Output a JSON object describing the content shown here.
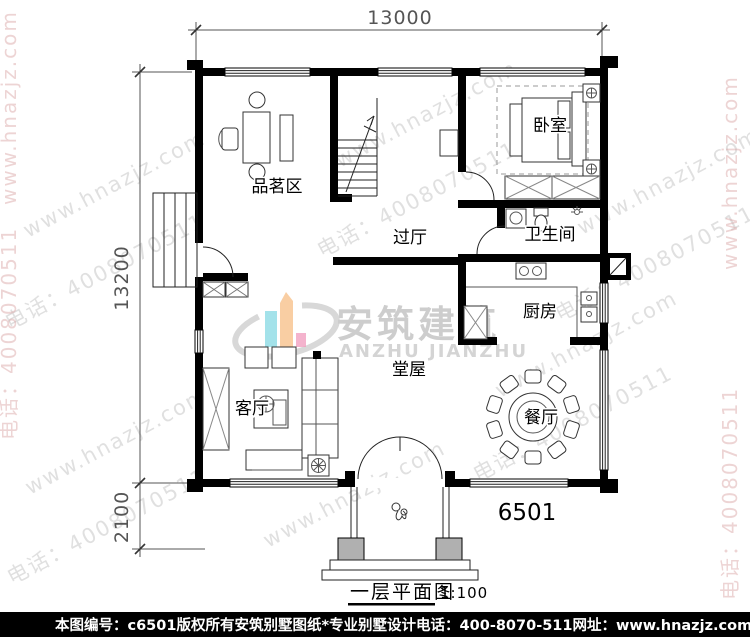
{
  "dimensions": {
    "width_top": "13000",
    "height_main": "13200",
    "height_porch": "2100"
  },
  "rooms": {
    "tea": "品茗区",
    "bedroom": "卧室",
    "hallway": "过厅",
    "bathroom": "卫生间",
    "kitchen": "厨房",
    "hall": "堂屋",
    "living": "客厅",
    "dining": "餐厅"
  },
  "plan": {
    "number": "6501",
    "title": "一层平面图",
    "scale": "1:100"
  },
  "watermark": {
    "site": "www.hnazjz.com",
    "phone": "电话：4008070511",
    "logo_cn": "安筑建筑",
    "logo_en": "ANZHU JIANZHU"
  },
  "footer": {
    "doc_no": "本图编号：c6501",
    "rights": "版权所有",
    "brand": "安筑别墅图纸*专业别墅设计",
    "phone": "电话：400-8070-511",
    "site": "网址：www.hnazjz.com"
  },
  "colors": {
    "wall": "#000000",
    "footer_bg": "#000000",
    "footer_text": "#ffffff",
    "watermark_gray": "#c7c7c7",
    "watermark_pink": "#dcaaaa",
    "logo_cyan": "#9adfe8",
    "logo_orange": "#f9c99a",
    "logo_pink": "#ef8fb5",
    "logo_gray": "#c8c8c8"
  }
}
